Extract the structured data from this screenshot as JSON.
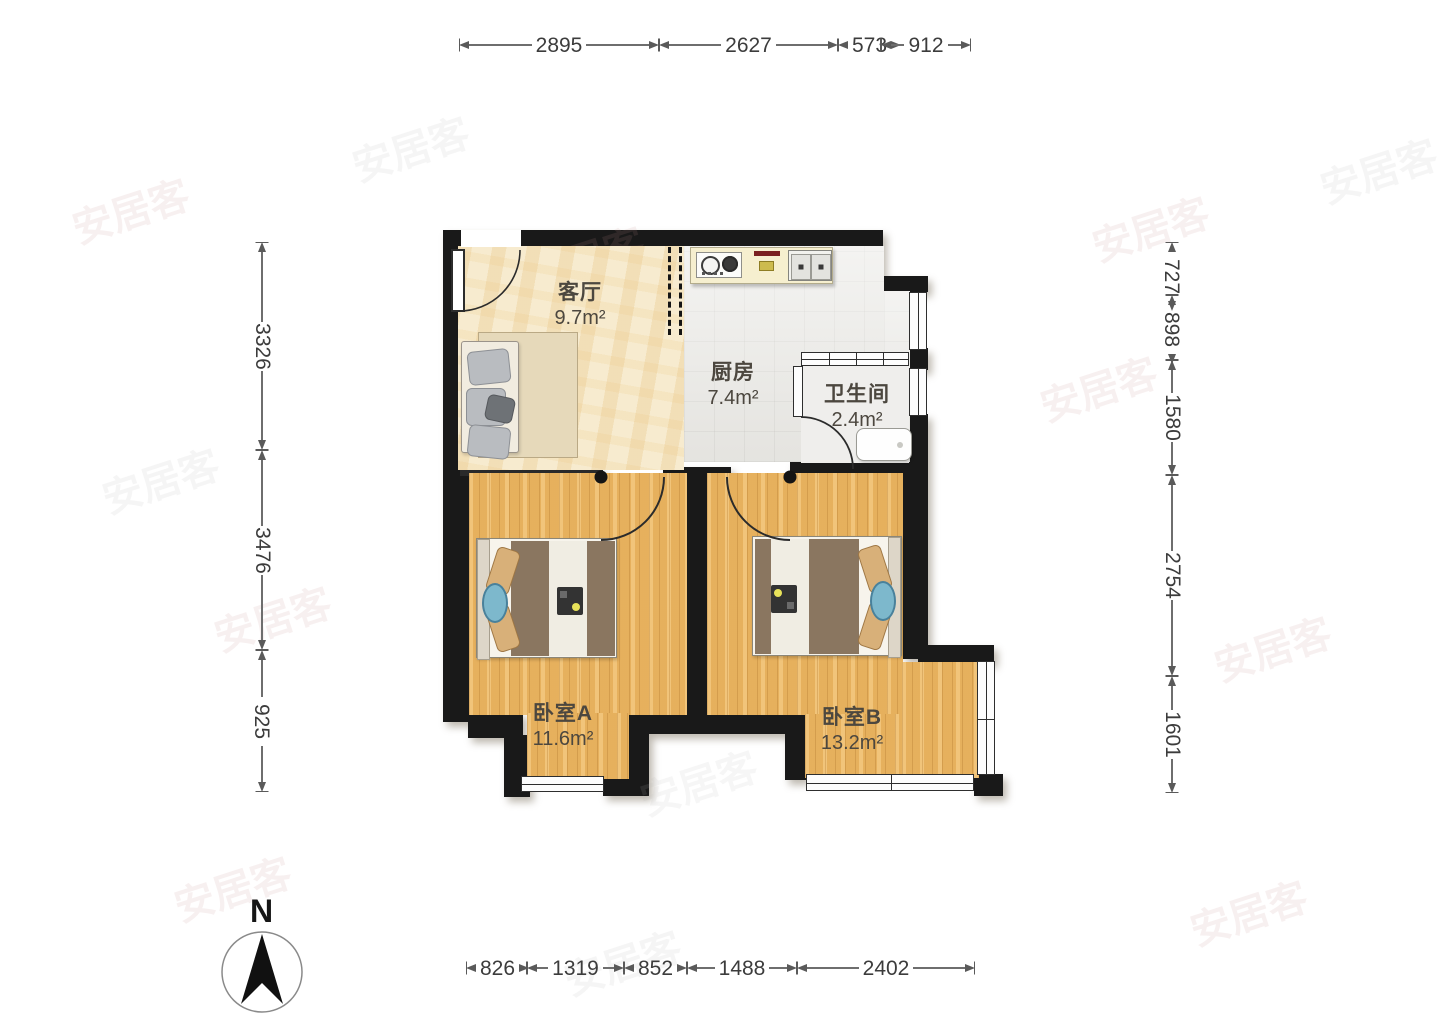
{
  "watermark": "安居客",
  "compass": {
    "label": "N"
  },
  "rooms": [
    {
      "name": "客厅",
      "area": "9.7m²"
    },
    {
      "name": "厨房",
      "area": "7.4m²"
    },
    {
      "name": "卫生间",
      "area": "2.4m²"
    },
    {
      "name": "卧室A",
      "area": "11.6m²"
    },
    {
      "name": "卧室B",
      "area": "13.2m²"
    }
  ],
  "dims": {
    "top": [
      "2895",
      "2627",
      "573",
      "912"
    ],
    "left": [
      "3326",
      "3476",
      "925"
    ],
    "right": [
      "727",
      "898",
      "1580",
      "2754",
      "1601"
    ],
    "bottom": [
      "826",
      "1319",
      "852",
      "1488",
      "2402"
    ]
  },
  "colors": {
    "wall": "#191919",
    "wood_floor": "#ecb763",
    "living_floor": "#f7ebcf",
    "kitchen_floor": "#e9e8e4",
    "accent_blue": "#7db8cc",
    "blanket_brown": "#8a7660"
  }
}
